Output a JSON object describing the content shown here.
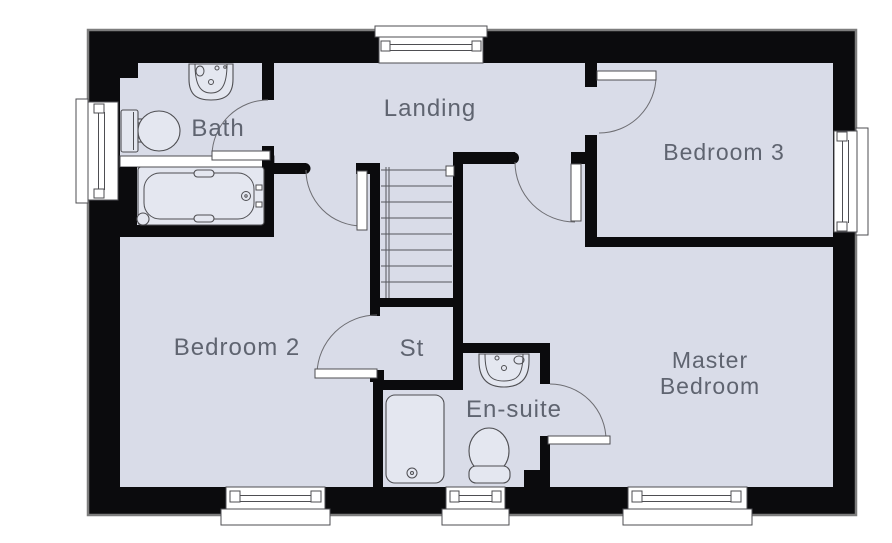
{
  "rooms": {
    "landing": {
      "label": "Landing"
    },
    "bath": {
      "label": "Bath"
    },
    "bedroom3": {
      "label": "Bedroom 3"
    },
    "bedroom2": {
      "label": "Bedroom 2"
    },
    "storage": {
      "label": "St"
    },
    "ensuite": {
      "label": "En-suite"
    },
    "master": {
      "line1": "Master",
      "line2": "Bedroom"
    }
  },
  "fixtures": {
    "bath": [
      "sink",
      "toilet",
      "bathtub"
    ],
    "ensuite": [
      "sink",
      "toilet",
      "shower-tray"
    ],
    "stairs": {
      "treads": 9
    }
  },
  "openings": {
    "doors": 6,
    "windows": 6
  },
  "colors": {
    "background": "#ffffff",
    "floor": "#d9dce8",
    "wall": "#0b0b0d",
    "label": "#5f6470",
    "line": "#4e4e52",
    "fixture": "#e4e7f0",
    "outline": "#7d7d7d"
  }
}
